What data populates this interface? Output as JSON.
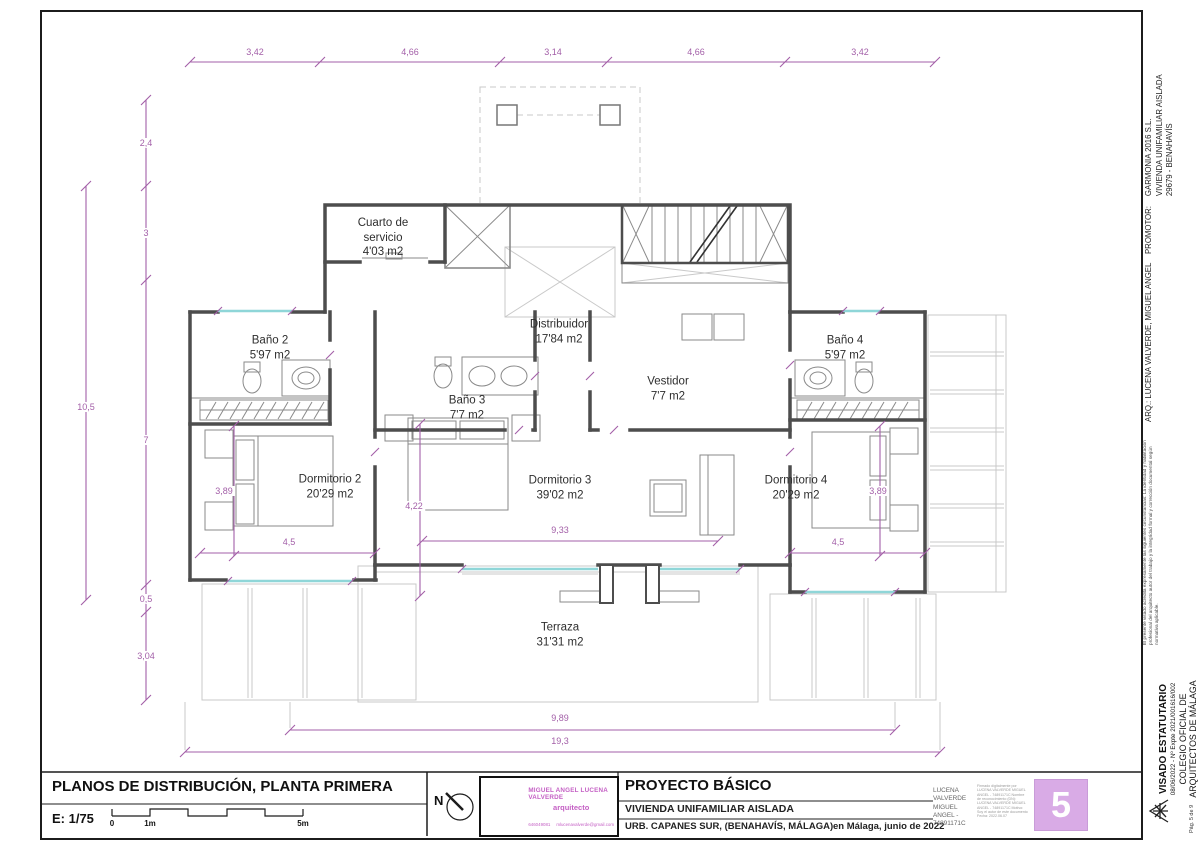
{
  "rooms": {
    "cuarto": {
      "name": "Cuarto de servicio",
      "area": "4'03 m2"
    },
    "distribuidor": {
      "name": "Distribuidor",
      "area": "17'84 m2"
    },
    "bano2": {
      "name": "Baño 2",
      "area": "5'97 m2"
    },
    "bano3": {
      "name": "Baño 3",
      "area": "7'7 m2"
    },
    "bano4": {
      "name": "Baño 4",
      "area": "5'97 m2"
    },
    "vestidor": {
      "name": "Vestidor",
      "area": "7'7 m2"
    },
    "dorm2": {
      "name": "Dormitorio 2",
      "area": "20'29 m2"
    },
    "dorm3": {
      "name": "Dormitorio 3",
      "area": "39'02 m2"
    },
    "dorm4": {
      "name": "Dormitorio 4",
      "area": "20'29 m2"
    },
    "terraza": {
      "name": "Terraza",
      "area": "31'31 m2"
    }
  },
  "dims": {
    "top": [
      "3,42",
      "4,66",
      "3,14",
      "4,66",
      "3,42"
    ],
    "left_outer": "10,5",
    "left_inner": [
      "2,4",
      "3",
      "7",
      "0,5",
      "3,04"
    ],
    "bottom": [
      "9,89",
      "19,3"
    ],
    "inner": {
      "dorm2_h": "3,89",
      "dorm2_w": "4,5",
      "dorm3_left": "4,22",
      "dorm3_w": "9,33",
      "dorm4_h": "3,89",
      "dorm4_w": "4,5"
    }
  },
  "titleblock": {
    "title": "PLANOS DE DISTRIBUCIÓN, PLANTA PRIMERA",
    "scale": "E: 1/75",
    "scalebar": {
      "zero": "0",
      "one": "1m",
      "five": "5m"
    },
    "north_label": "N",
    "stamp": {
      "name": "MIGUEL ANGEL LUCENA VALVERDE",
      "role": "arquitecto",
      "phone": "646049081",
      "email": "mlucenavalverde@gmail.com"
    },
    "project": {
      "type": "PROYECTO BÁSICO",
      "subtitle": "VIVIENDA UNIFAMILIAR AISLADA",
      "location": "URB. CAPANES SUR, (BENAHAVÍS, MÁLAGA)",
      "date": "en Málaga, junio de 2022"
    },
    "signature": {
      "name": "LUCENA VALVERDE MIGUEL ANGEL - 74891171C",
      "digital": "Firmado digitalmente por LUCENA VALVERDE MIGUEL ANGEL - 74891171C Nombre de reconocimiento (DN): LUCENA VALVERDE MIGUEL ANGEL - 74891171C Motivo: Soy el autor de este documento Fecha: 2022.06.07"
    },
    "sheet_number": "5"
  },
  "sidebar": {
    "arq": "ARQ.: LUCENA VALVERDE, MIGUEL ANGEL",
    "promotor_label": "PROMOTOR:",
    "promotor_name": "GARMONIA 2016 S.L.",
    "promotor_line2": "VIVIENDA UNIFAMILIAR AISLADA",
    "promotor_line3": "29679 - BENAHAVÍS",
    "visado_note": "El presente visado acredita expresamente las siguientes circunstancias: La identidad y habilitación profesional del arquitecto autor del trabajo y la integridad formal y corrección documental según normativa aplicable.",
    "visado_title": "VISADO ESTATUTARIO",
    "visado_ref": "08/06/2022 - Nº Expte 2021/001616/002",
    "colegio_line1": "COLEGIO OFICIAL DE",
    "colegio_line2": "ARQUITECTOS DE MÁLAGA",
    "page_info": "Pág. 5 de 9"
  },
  "colors": {
    "wall": "#4d4d4d",
    "dim_magenta": "#a35fa8",
    "window_cyan": "#8fd6d8",
    "sheet_lavender": "#d9abe6",
    "stamp_magenta": "#c45fc4"
  }
}
